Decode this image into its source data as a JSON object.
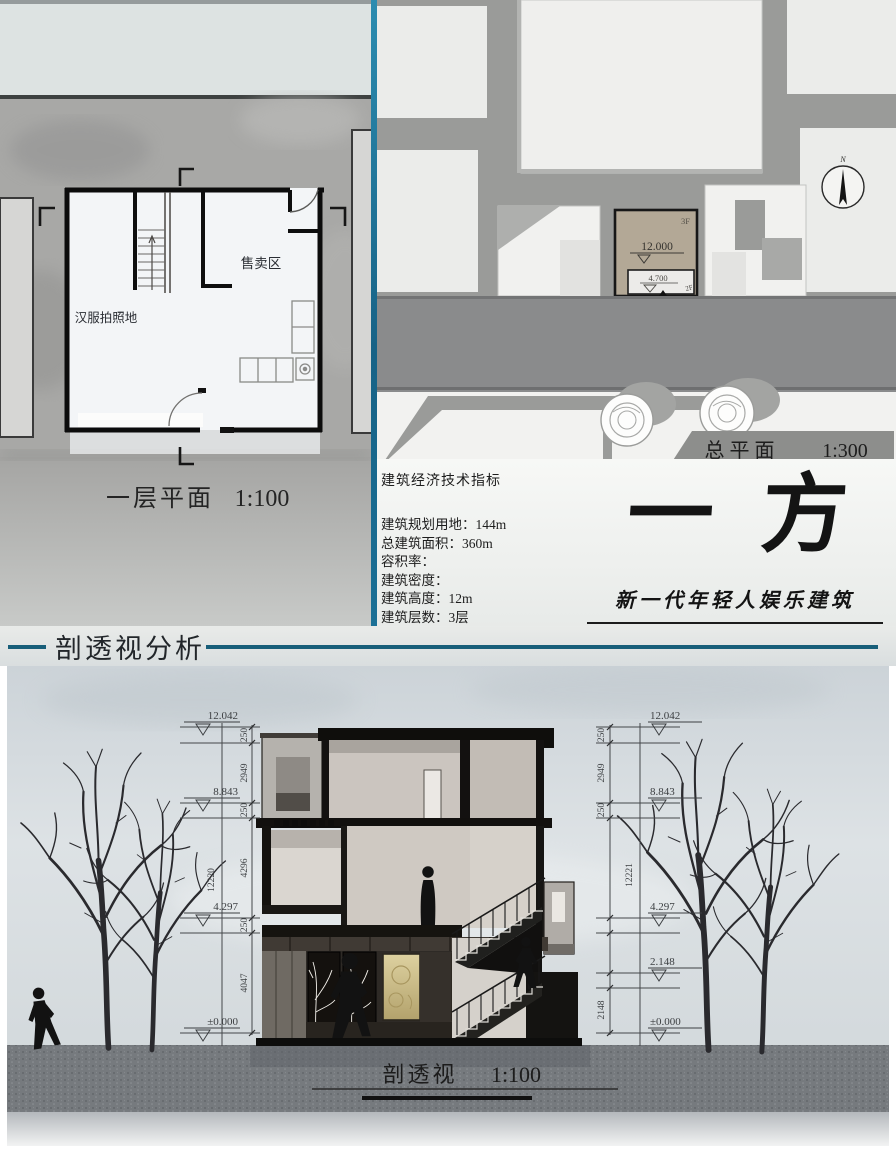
{
  "floor_plan": {
    "caption": "一层平面",
    "scale": "1:100",
    "label_sales": "售卖区",
    "label_hanfu": "汉服拍照地"
  },
  "site_plan": {
    "caption": "总平面",
    "scale": "1:300",
    "floors_top": "3F",
    "elev_top": "12.000",
    "elev_entry": "4.700",
    "floors_entry": "2F",
    "entrance": "入口",
    "north": "N"
  },
  "indicators": {
    "title": "建筑经济技术指标",
    "items": [
      {
        "label": "建筑规划用地：",
        "value": "144m"
      },
      {
        "label": "总建筑面积：",
        "value": "360m"
      },
      {
        "label": "容积率：",
        "value": ""
      },
      {
        "label": "建筑密度：",
        "value": ""
      },
      {
        "label": "建筑高度：",
        "value": "12m"
      },
      {
        "label": "建筑层数：",
        "value": "3层"
      }
    ]
  },
  "branding": {
    "title_char1": "一",
    "title_char2": "方",
    "subtitle": "新一代年轻人娱乐建筑"
  },
  "section": {
    "heading": "剖透视分析",
    "caption": "剖透视",
    "scale": "1:100",
    "dims_left": {
      "elevations": [
        "12.042",
        "8.843",
        "4.297",
        "±0.000"
      ],
      "segments": [
        "250",
        "2949",
        "250",
        "4296",
        "250",
        "4047"
      ],
      "overall": "12220"
    },
    "dims_right": {
      "elevations": [
        "12.042",
        "8.843",
        "4.297",
        "2.148",
        "±0.000"
      ],
      "segments": [
        "250",
        "2949",
        "250",
        "2148"
      ],
      "overall": "12221"
    }
  },
  "colors": {
    "accent_teal": "#176286",
    "site_building_tan": "#b3a896",
    "gold_panel": "#d2c48e",
    "road_gray": "#8a8b8c"
  }
}
